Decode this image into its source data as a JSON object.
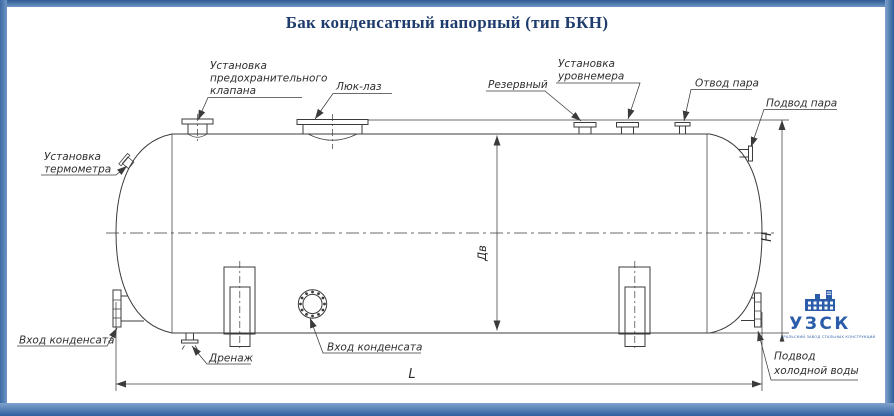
{
  "title": "Бак конденсатный напорный (тип БКН)",
  "labels": {
    "safety_valve": [
      "Установка",
      "предохранительного",
      "клапана"
    ],
    "manhole": "Люк-лаз",
    "reserve": "Резервный",
    "level_gauge": [
      "Установка",
      "уровнемера"
    ],
    "steam_outlet": "Отвод пара",
    "steam_inlet": "Подвод пара",
    "thermometer": [
      "Установка",
      "термометра"
    ],
    "condensate_inlet_left": "Вход конденсата",
    "drain": "Дренаж",
    "condensate_inlet_center": "Вход конденсата",
    "cold_water_inlet": [
      "Подвод",
      "холодной воды"
    ]
  },
  "dimensions": {
    "diameter": "Дв",
    "height": "H",
    "length": "L"
  },
  "logo": {
    "name": "УЗСК",
    "tagline": "УРАЛЬСКИЙ ЗАВОД СТАЛЬНЫХ КОНСТРУКЦИЙ"
  },
  "colors": {
    "frame_blue": "#4a7ab2",
    "frame_blue_dark": "#2f5f9e",
    "title_navy": "#1f3c6d",
    "logo_blue": "#2a5ca9",
    "line_gray": "#3b3b3b"
  }
}
